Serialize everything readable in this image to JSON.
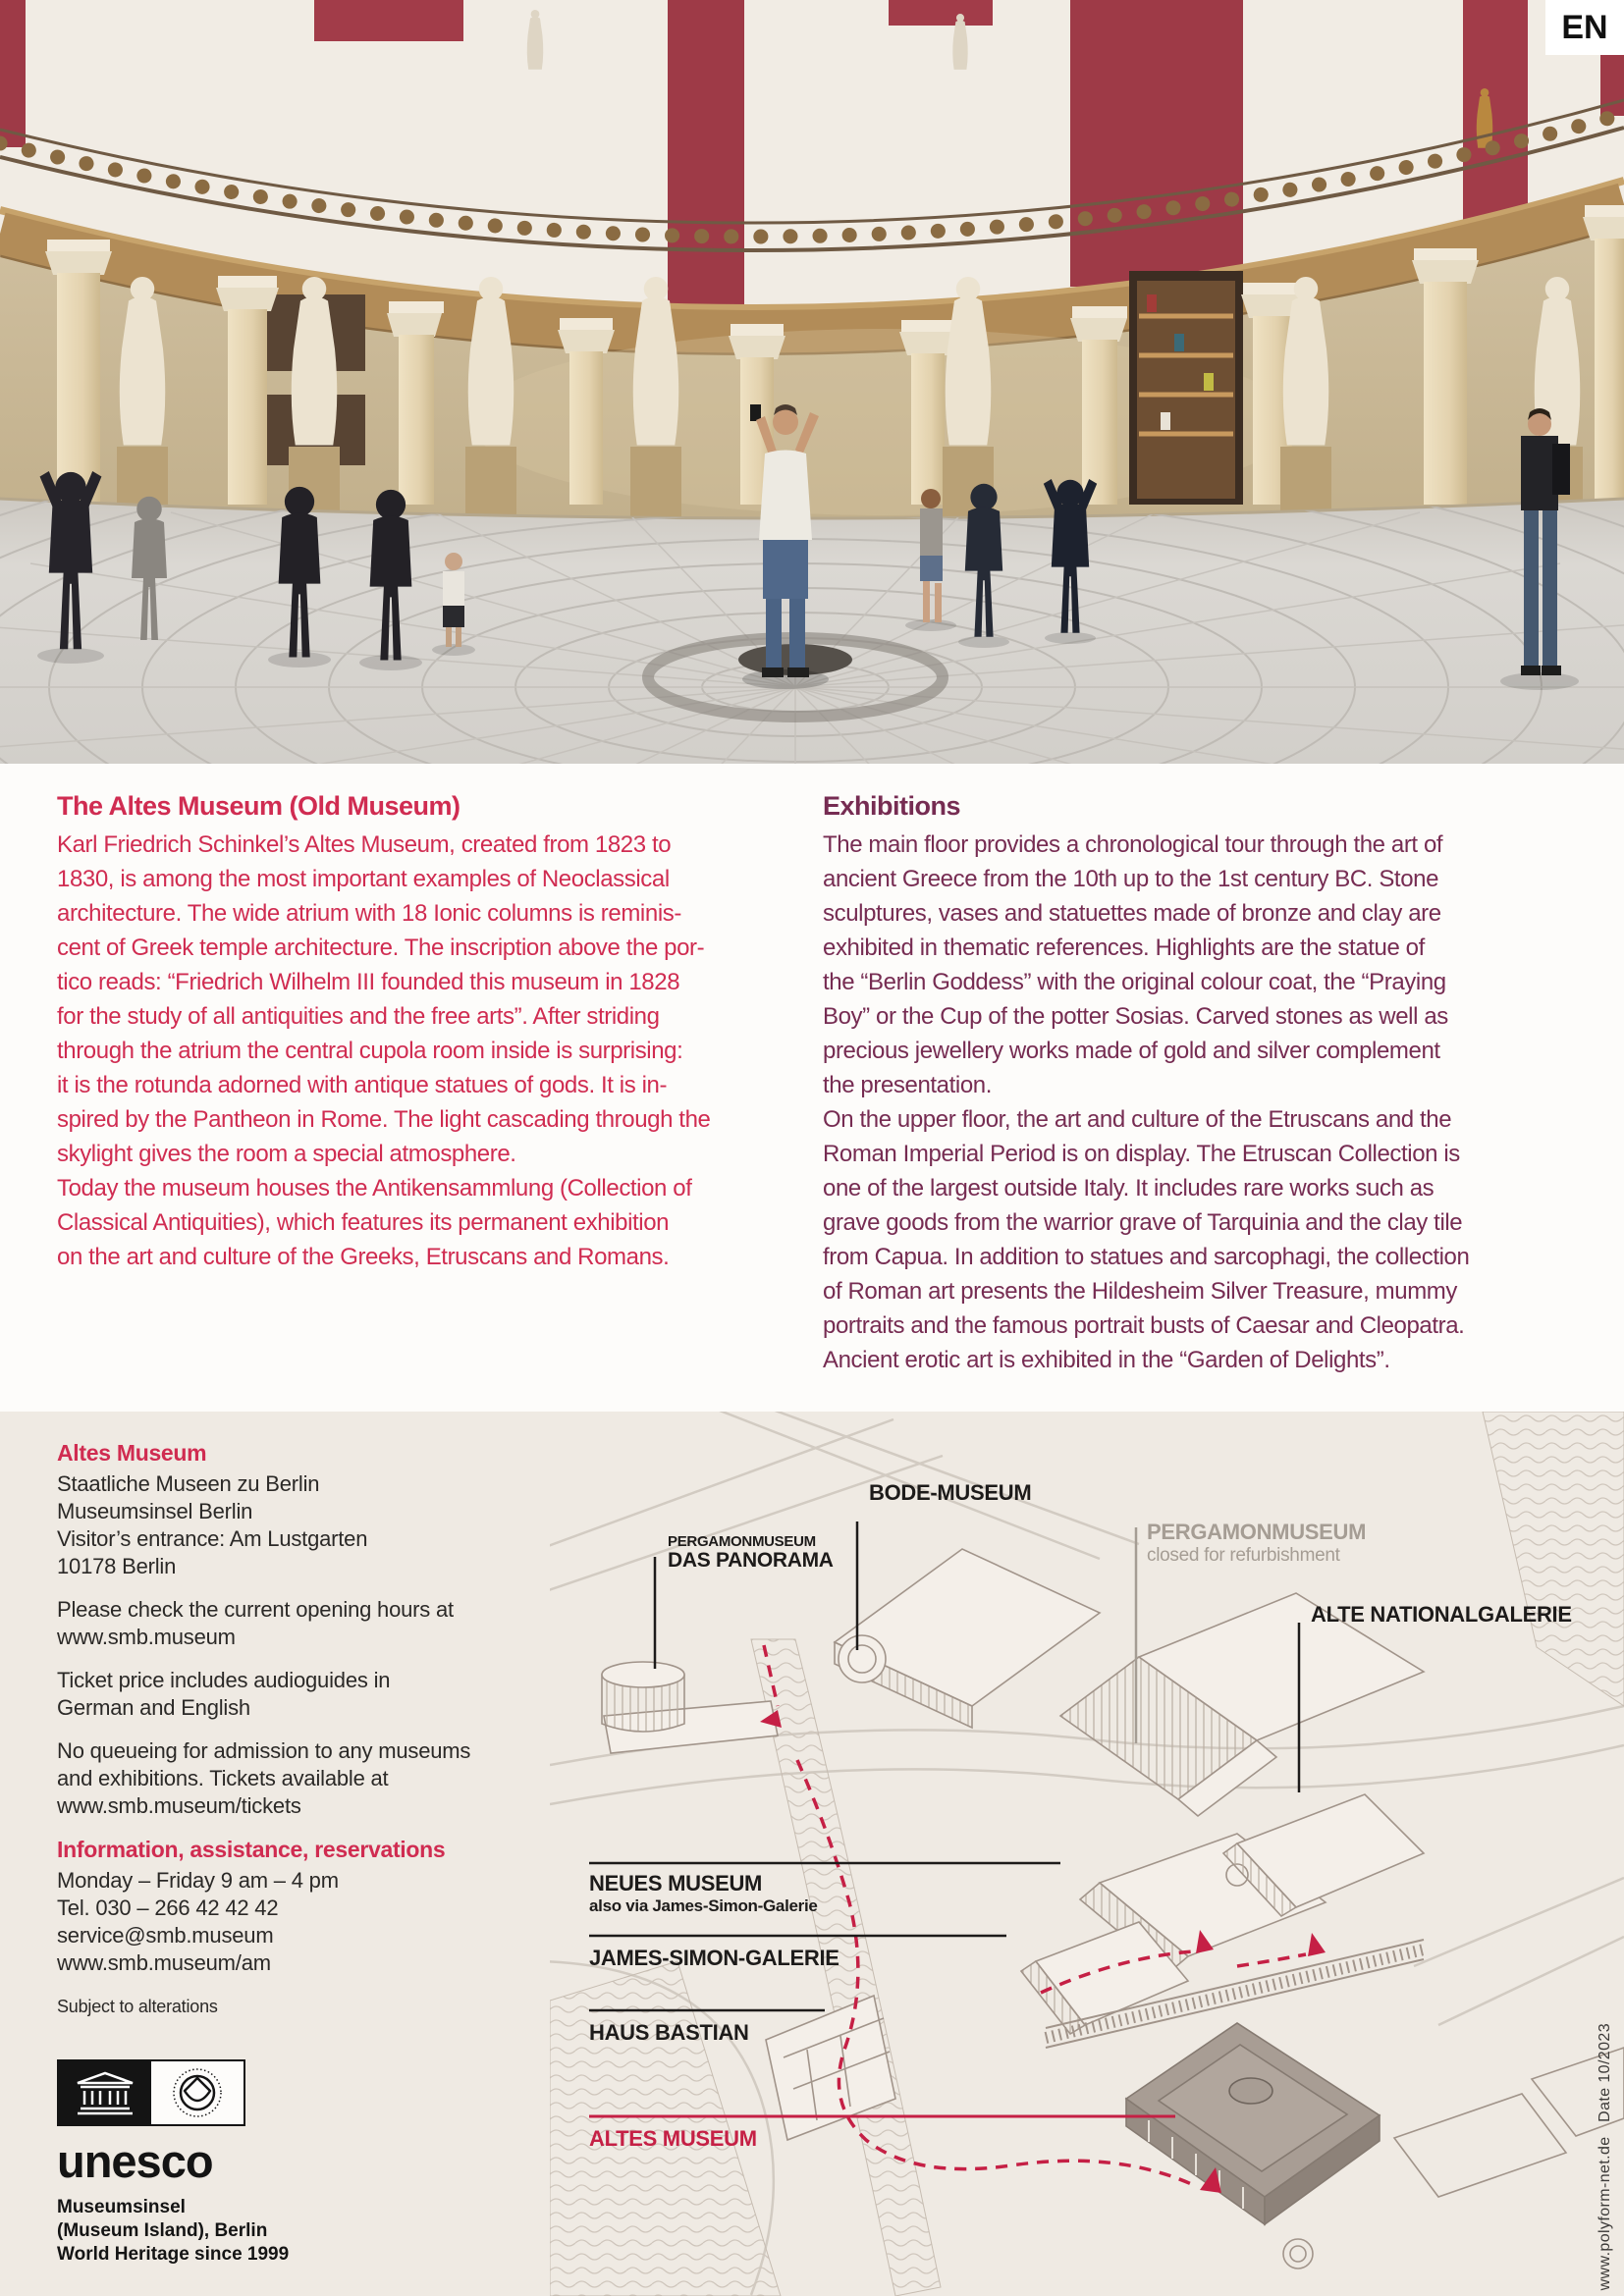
{
  "page": {
    "lang_badge": "EN"
  },
  "intro": {
    "heading": "The Altes Museum (Old Museum)",
    "body": "Karl Friedrich Schinkel’s Altes Museum, created from 1823 to\n1830, is among the most important examples of Neoclassical\narchitecture. The wide atrium with 18 Ionic columns is reminis-\ncent of Greek temple architecture. The inscription above the por-\ntico reads: “Friedrich Wilhelm III founded this museum in 1828\nfor the study of all antiquities and the free arts”. After striding\nthrough the atrium the central cupola room inside is surprising:\nit is the rotunda adorned with antique statues of gods. It is in-\nspired by the Pantheon in Rome. The light cascading through the\nskylight gives the room a special atmosphere.\nToday the museum houses the Antikensammlung (Collection of\nClassical Antiquities), which features its permanent exhibition\non the art and culture of the Greeks, Etruscans and Romans."
  },
  "exhibitions": {
    "heading": "Exhibitions",
    "body": "The main floor provides a chronological tour through the art of\nancient Greece from the 10th up to the 1st century BC. Stone\nsculptures, vases and statuettes made of bronze and clay are\nexhibited in thematic references. Highlights are the statue of\nthe “Berlin Goddess” with the original colour coat, the “Praying\nBoy” or the Cup of the potter Sosias. Carved stones as well as\nprecious jewellery works made of gold and silver complement\nthe presentation.\nOn the upper floor, the art and culture of the Etruscans and the\nRoman Imperial Period is on display. The Etruscan Collection is\none of the largest outside Italy. It includes rare works such as\ngrave goods from the warrior grave of Tarquinia and the clay tile\nfrom Capua. In addition to statues and sarcophagi, the collection\nof Roman art presents the Hildesheim Silver Treasure, mummy\nportraits and the famous portrait busts of Caesar and Cleopatra.\nAncient erotic art is exhibited in the “Garden of Delights”."
  },
  "info": {
    "museum_heading": "Altes Museum",
    "address": "Staatliche Museen zu Berlin\nMuseumsinsel Berlin\nVisitor’s entrance: Am Lustgarten\n10178 Berlin",
    "hours": "Please check the current opening hours at\nwww.smb.museum",
    "audioguides": "Ticket price includes audioguides in\nGerman and English",
    "tickets": "No queueing for admission to any museums\nand exhibitions. Tickets available at\nwww.smb.museum/tickets",
    "contact_heading": "Information, assistance, reservations",
    "contact": "Monday – Friday 9 am – 4 pm\nTel. 030 – 266 42 42 42\nservice@smb.museum\nwww.smb.museum/am",
    "note": "Subject to alterations"
  },
  "unesco": {
    "wordmark": "unesco",
    "caption": "Museumsinsel\n(Museum Island), Berlin\nWorld Heritage since 1999"
  },
  "map": {
    "labels": {
      "bode": "BODE-MUSEUM",
      "panorama_top": "PERGAMONMUSEUM",
      "panorama": "DAS PANORAMA",
      "pergamon": "PERGAMONMUSEUM",
      "pergamon_sub": "closed for refurbishment",
      "alte_nationalgalerie": "ALTE NATIONALGALERIE",
      "neues": "NEUES MUSEUM",
      "neues_sub": "also via James-Simon-Galerie",
      "james_simon": "JAMES-SIMON-GALERIE",
      "haus_bastian": "HAUS BASTIAN",
      "altes": "ALTES MUSEUM"
    },
    "credit": "www.polyform-net.de   Date 10/2023"
  },
  "colors": {
    "accent_red": "#d02c51",
    "plum": "#762c52",
    "map_red": "#c52045",
    "beige_bg": "#efeae3",
    "gray_label": "#a59d94"
  }
}
